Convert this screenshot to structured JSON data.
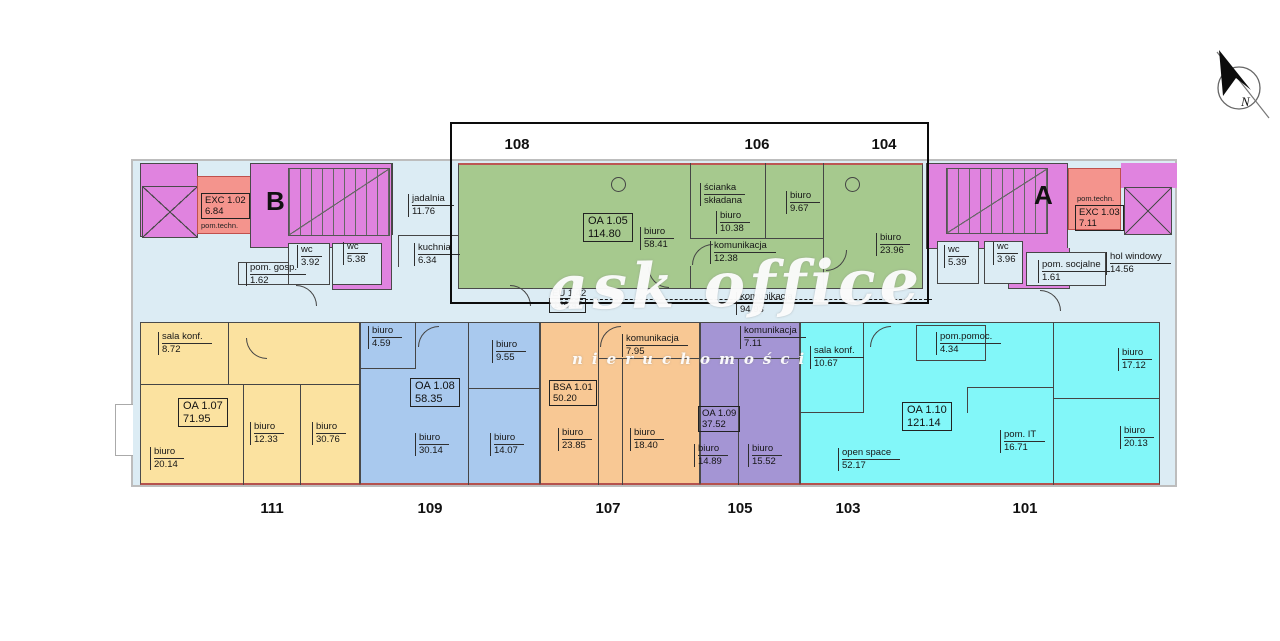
{
  "top_units": [
    "108",
    "106",
    "104"
  ],
  "bottom_units": [
    "111",
    "109",
    "107",
    "105",
    "103",
    "101"
  ],
  "stairwells": {
    "b": "B",
    "a": "A"
  },
  "compass": {
    "label": "N"
  },
  "watermark": {
    "line1": "ask office",
    "line2": "nieruchomości"
  },
  "colors": {
    "magenta": "#e083df",
    "salmon": "#f4948d",
    "salmon_border": "#c0504d",
    "lightblue": "#dcecf4",
    "green": "#a6c98e",
    "yellow": "#fbe2a0",
    "blue": "#a9c9ee",
    "orange": "#f8c894",
    "purple": "#a495d4",
    "cyan": "#82f7f9"
  },
  "rooms": {
    "exc102": {
      "name": "EXC 1.02",
      "area": "6.84",
      "note": "pom.techn."
    },
    "pom_gosp": {
      "name": "pom. gosp.",
      "area": "1.62"
    },
    "wc_b1": {
      "name": "wc",
      "area": "3.92"
    },
    "wc_b2": {
      "name": "wc",
      "area": "5.38"
    },
    "jadalnia": {
      "name": "jadalnia",
      "area": "11.76"
    },
    "kuchnia": {
      "name": "kuchnia",
      "area": "6.34"
    },
    "oa105": {
      "name": "OA 1.05",
      "area": "114.80"
    },
    "biuro_5841": {
      "name": "biuro",
      "area": "58.41"
    },
    "scianka": {
      "line1": "ścianka",
      "line2": "składana"
    },
    "biuro_1038": {
      "name": "biuro",
      "area": "10.38"
    },
    "biuro_967": {
      "name": "biuro",
      "area": "9.67"
    },
    "kom_1238": {
      "name": "komunikacja",
      "area": "12.38"
    },
    "biuro_2396": {
      "name": "biuro",
      "area": "23.96"
    },
    "wc_a1": {
      "name": "wc",
      "area": "5.39"
    },
    "wc_a2": {
      "name": "wc",
      "area": "3.96"
    },
    "exc103": {
      "name": "EXC 1.03",
      "area": "7.11",
      "note": "pom.techn."
    },
    "pom_socjalne": {
      "name": "pom. socjalne",
      "area": "1.61"
    },
    "hol_windowy": {
      "name": "hol windowy",
      "area": "14.56"
    },
    "corridor": {
      "name": "EU 1.42",
      "area": "149.47"
    },
    "kom_9493": {
      "name": "komunikacja",
      "area": "94.93"
    },
    "sala_konf_b": {
      "name": "sala konf.",
      "area": "8.72"
    },
    "oa107": {
      "name": "OA 1.07",
      "area": "71.95"
    },
    "biuro_1233": {
      "name": "biuro",
      "area": "12.33"
    },
    "biuro_3076": {
      "name": "biuro",
      "area": "30.76"
    },
    "biuro_2014": {
      "name": "biuro",
      "area": "20.14"
    },
    "biuro_459": {
      "name": "biuro",
      "area": "4.59"
    },
    "biuro_955": {
      "name": "biuro",
      "area": "9.55"
    },
    "oa108": {
      "name": "OA 1.08",
      "area": "58.35"
    },
    "biuro_3014": {
      "name": "biuro",
      "area": "30.14"
    },
    "biuro_1407": {
      "name": "biuro",
      "area": "14.07"
    },
    "kom_795": {
      "name": "komunikacja",
      "area": "7.95"
    },
    "bsa101": {
      "name": "BSA 1.01",
      "area": "50.20"
    },
    "biuro_2385": {
      "name": "biuro",
      "area": "23.85"
    },
    "biuro_1840": {
      "name": "biuro",
      "area": "18.40"
    },
    "kom_711": {
      "name": "komunikacja",
      "area": "7.11"
    },
    "oa109": {
      "name": "OA 1.09",
      "area": "37.52"
    },
    "biuro_1489": {
      "name": "biuro",
      "area": "14.89"
    },
    "biuro_1552": {
      "name": "biuro",
      "area": "15.52"
    },
    "sala_konf_c": {
      "name": "sala konf.",
      "area": "10.67"
    },
    "pom_pomoc": {
      "name": "pom.pomoc.",
      "area": "4.34"
    },
    "oa110": {
      "name": "OA 1.10",
      "area": "121.14"
    },
    "open_space": {
      "name": "open space",
      "area": "52.17"
    },
    "pom_it": {
      "name": "pom. IT",
      "area": "16.71"
    },
    "biuro_1712": {
      "name": "biuro",
      "area": "17.12"
    },
    "biuro_2013": {
      "name": "biuro",
      "area": "20.13"
    }
  }
}
